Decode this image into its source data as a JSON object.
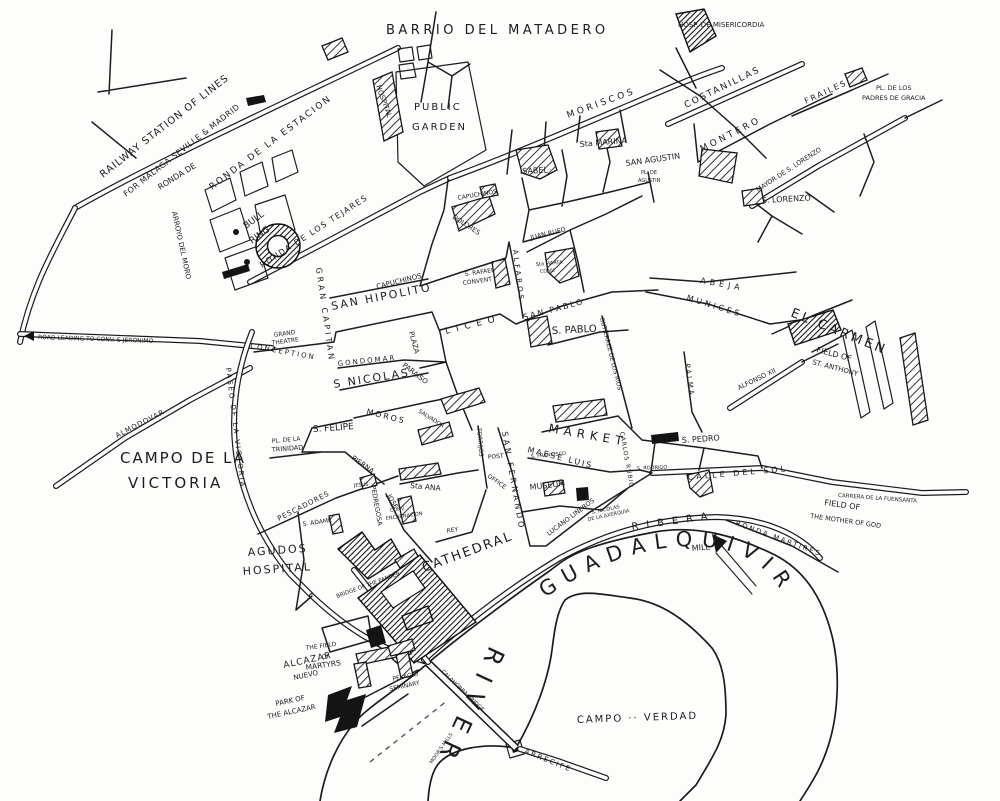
{
  "map": {
    "colors": {
      "ink": "#1c1c1c",
      "paper": "#fdfdfc"
    },
    "labels": {
      "barrio_matadero": "BARRIO DEL MATADERO",
      "railway_line1": "RAILWAY STATION OF LINES",
      "railway_line2": "FOR MALAGA SEVILLE & MADRID",
      "ronda_estacion": "RONDA DE LA ESTACION",
      "ronda_de": "RONDA DE",
      "arroyo_moro": "ARROYO DEL MORO",
      "hospital_station": "HOSPITAL",
      "public_garden1": "PUBLIC",
      "public_garden2": "GARDEN",
      "misericordia": "HOSP. DE MISERICORDIA",
      "moriscos": "MORISCOS",
      "costanillas": "COSTANILLAS",
      "montero": "MONTERO",
      "frailes": "FRAILES",
      "padres1": "PL. DE LOS",
      "padres2": "PADRES DE GRACIA",
      "sta_marina": "Sta MARINA",
      "isabel": "ISABEL",
      "san_agustin": "SAN AGUSTIN",
      "pl_agustin1": "PL. DE",
      "pl_agustin2": "AGUSTIN",
      "mayor_lorenzo": "MAYOR DE S. LORENZO",
      "s_lorenzo": "S. LORENZO",
      "abeja": "ABEJA",
      "munices": "MUNICES",
      "el_carmen": "EL CARMEN",
      "anthony1": "FIELD OF",
      "anthony2": "ST. ANTHONY",
      "capuchinos_street": "CAPUCHINOS",
      "capuchinos_plaza": "CAPUCHINOS",
      "dolores": "DOLORES",
      "rafael1": "S. RAFAEL",
      "rafael2": "CONVENT",
      "bull1": "BULL",
      "bull2": "RING",
      "ronda_tejares": "RONDA DE LOS TEJARES",
      "gran_capitan": "GRAN CAPITAN",
      "san_hipolito": "SAN HIPOLITO",
      "liceo": "LICEO",
      "alfaros": "ALFAROS",
      "theatre1": "GRAND",
      "theatre2": "THEATRE",
      "conception": "CONCEPTION",
      "gondomar": "GONDOMAR",
      "s_nicolas": "S NICOLAS",
      "plaza": "PLAZA",
      "paraiso": "PARAISO",
      "moros": "MOROS",
      "salvador": "SALVADOR",
      "s_felipe": "S. FELIPE",
      "trinidad1": "PL. DE LA",
      "trinidad2": "TRINIDAD",
      "pierna": "PIERNA",
      "pescadores": "PESCADORES",
      "paseo_victoria": "PASEO DE LA VICTORIA",
      "campo_victoria1": "CAMPO DE LA",
      "campo_victoria2": "VICTORIA",
      "almodovar": "ALMODOVAR",
      "jeronimo": "ROAD LEADING TO CONV. S JERONIMO",
      "jesus": "JESUS",
      "s_adame": "S. ADAME",
      "pedregosa": "PEDREGOSA",
      "sta_ana": "Sta ANA",
      "jose": "JOSE",
      "encarnacion1": "CONV.",
      "encarnacion2": "ENCARNACION",
      "rey": "REY",
      "agudos1": "AGUDOS",
      "agudos2": "HOSPITAL",
      "bridge_pander": "BRIDGE OF THE PANDER",
      "torrijos": "TORRIJOS",
      "post1": "POST",
      "post2": "OFFICE",
      "san_fernando": "SAN FERNANDO",
      "museum": "MUSEUM",
      "s_francisco": "S. FRANCISCO",
      "maese_luis": "MAESE LUIS",
      "market": "MARKET",
      "carlos_rubio": "CARLOS RUBIO",
      "gutierrez": "GUTIERREZ DE LOS RIOS",
      "palma": "PALMA",
      "san_pablo_street": "SAN PABLO",
      "s_pablo": "S. PABLO",
      "juan_rufo": "JUAN RUFO",
      "marta1": "Sta MARTA",
      "marta2": "CONV.",
      "s_pedro": "S. PEDRO",
      "s_rodrigo": "S. RODRIGO",
      "calle_sol": "CALLE DEL SOL",
      "ribera": "RIBERA",
      "ronda_martires": "RONDA MARTIRES",
      "lucano": "LUCANO LINEROS",
      "axerquia1": "S. NICOLAS",
      "axerquia2": "DE LA AXERQUIA",
      "alfonso": "ALFONSO XII",
      "carrera": "CARRERA DE LA FUENSANTA",
      "mother1": "FIELD OF",
      "mother2": "THE MOTHER OF GOD",
      "mill": "MILL",
      "campo_verdad": "CAMPO ·· VERDAD",
      "calahorra": "CALAHORRA BRIDGE",
      "arrecife": "ARRECIFE",
      "moors_mills": "MOOR'S MILLS",
      "alcazar1": "ALCAZAR",
      "alcazar2": "NUEVO",
      "park1": "PARK OF",
      "park2": "THE ALCAZAR",
      "martyrs1": "THE FIELD",
      "martyrs2": "OF",
      "martyrs3": "MARTYRS",
      "pelagio1": "PELAGIO",
      "pelagio2": "SEMINARY",
      "cathedral": "CATHEDRAL",
      "river": "RIVER",
      "guadalquivir": "GUADALQUIVIR"
    }
  }
}
